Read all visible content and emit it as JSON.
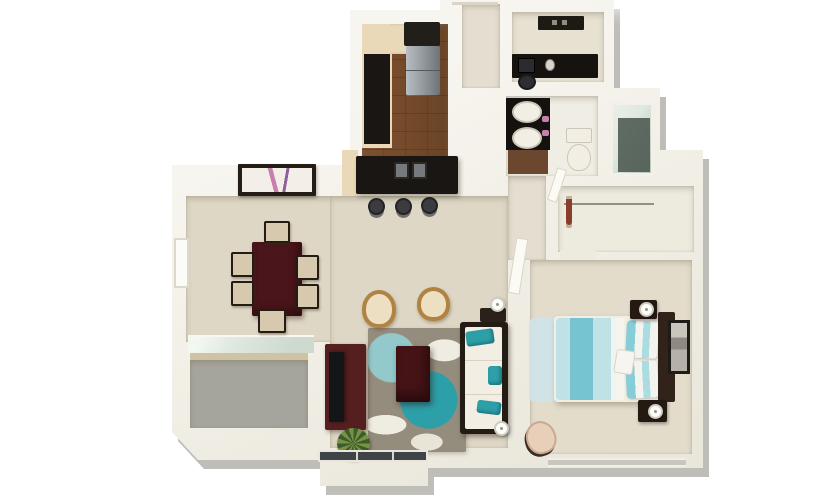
{
  "scene": {
    "description": "3D isometric render of a one-bedroom apartment floor plan on a white background, teal and espresso color scheme",
    "rooms": [
      {
        "name": "kitchen",
        "floor": "wood",
        "furniture": [
          "refrigerator",
          "upper-cabinet",
          "cream-counter",
          "black-countertop",
          "breakfast-island",
          "double-basin-sink",
          "bar-stool"
        ]
      },
      {
        "name": "entry-hall",
        "floor": "light",
        "furniture": []
      },
      {
        "name": "office-nook",
        "floor": "carpet",
        "furniture": [
          "wall-shelf",
          "desk",
          "monitor",
          "office-chair"
        ]
      },
      {
        "name": "bathroom",
        "floor": "tile",
        "furniture": [
          "double-sink-vanity",
          "toilet",
          "glass-shower"
        ]
      },
      {
        "name": "walk-in-closet",
        "floor": "light",
        "furniture": [
          "clothes-rod",
          "hanging-clothes"
        ]
      },
      {
        "name": "dining-area",
        "floor": "carpet",
        "furniture": [
          "dining-table",
          "dining-chair",
          "wall-art",
          "window"
        ]
      },
      {
        "name": "balcony",
        "floor": "concrete",
        "furniture": [
          "sliding-glass-door",
          "threshold-sill"
        ]
      },
      {
        "name": "living-room",
        "floor": "carpet",
        "furniture": [
          "floral-rug",
          "wicker-chair",
          "coffee-table",
          "sofa",
          "teal-pillow",
          "tv-stand",
          "flat-tv",
          "floor-lamp",
          "potted-plant",
          "sliding-glass-door",
          "side-table"
        ]
      },
      {
        "name": "bedroom",
        "floor": "carpet",
        "furniture": [
          "double-bed",
          "striped-duvet",
          "striped-pillow",
          "headboard",
          "nightstand",
          "table-lamp",
          "wall-art",
          "blue-rug",
          "accent-chair",
          "door",
          "window"
        ]
      }
    ]
  },
  "counts": {
    "dining_chairs": 6,
    "bar_stools": 3,
    "bathroom_sinks": 2,
    "wicker_chairs": 2,
    "nightstands": 2,
    "floor_lamps": 2,
    "table_lamps": 2,
    "teal_sofa_pillows": 3,
    "bed_pillows": 2
  },
  "palette": {
    "wall": "#f7f5ef",
    "wall-shade": "#e9e6da",
    "carpet": "#ded7c5",
    "carpet2": "#e3dccb",
    "wood": "#7d5130",
    "cream": "#ead9b9",
    "black": "#1a1613",
    "stainless": "#8f969b",
    "maroon": "#4a151b",
    "chair-seat": "#d6c9ae",
    "rug-gray": "#948c7d",
    "teal": "#2d9fa8",
    "teal-light": "#93c9cb",
    "espresso": "#241b15",
    "white-soft": "#f2eee3",
    "wicker": "#b08343",
    "aqua": "#bfe2e6",
    "aqua-band": "#76c3d2",
    "blue-rug": "#cfe3e8",
    "blush": "#e8cfba",
    "balcony": "#a6a59d",
    "glass": "#dfe9e0",
    "glass-dark": "#3e4346",
    "shower-dark": "#46544b",
    "bath-floor": "#f0ede4",
    "hall-floor": "#e5ded0",
    "office-floor": "#e7e1d2",
    "closet-floor": "#edeade",
    "pink": "#c77fae",
    "plant-dark": "#3f5b2e",
    "plant-light": "#769343"
  },
  "closet": {
    "clothes_colors": [
      "#cf6b2d",
      "#32405a",
      "#e9e5da",
      "#6f4a2f",
      "#3a7f8a",
      "#23242b",
      "#a85b32",
      "#d8d0bf",
      "#4c5a3c",
      "#2e3038",
      "#c2b49a",
      "#8a3d2c"
    ]
  }
}
